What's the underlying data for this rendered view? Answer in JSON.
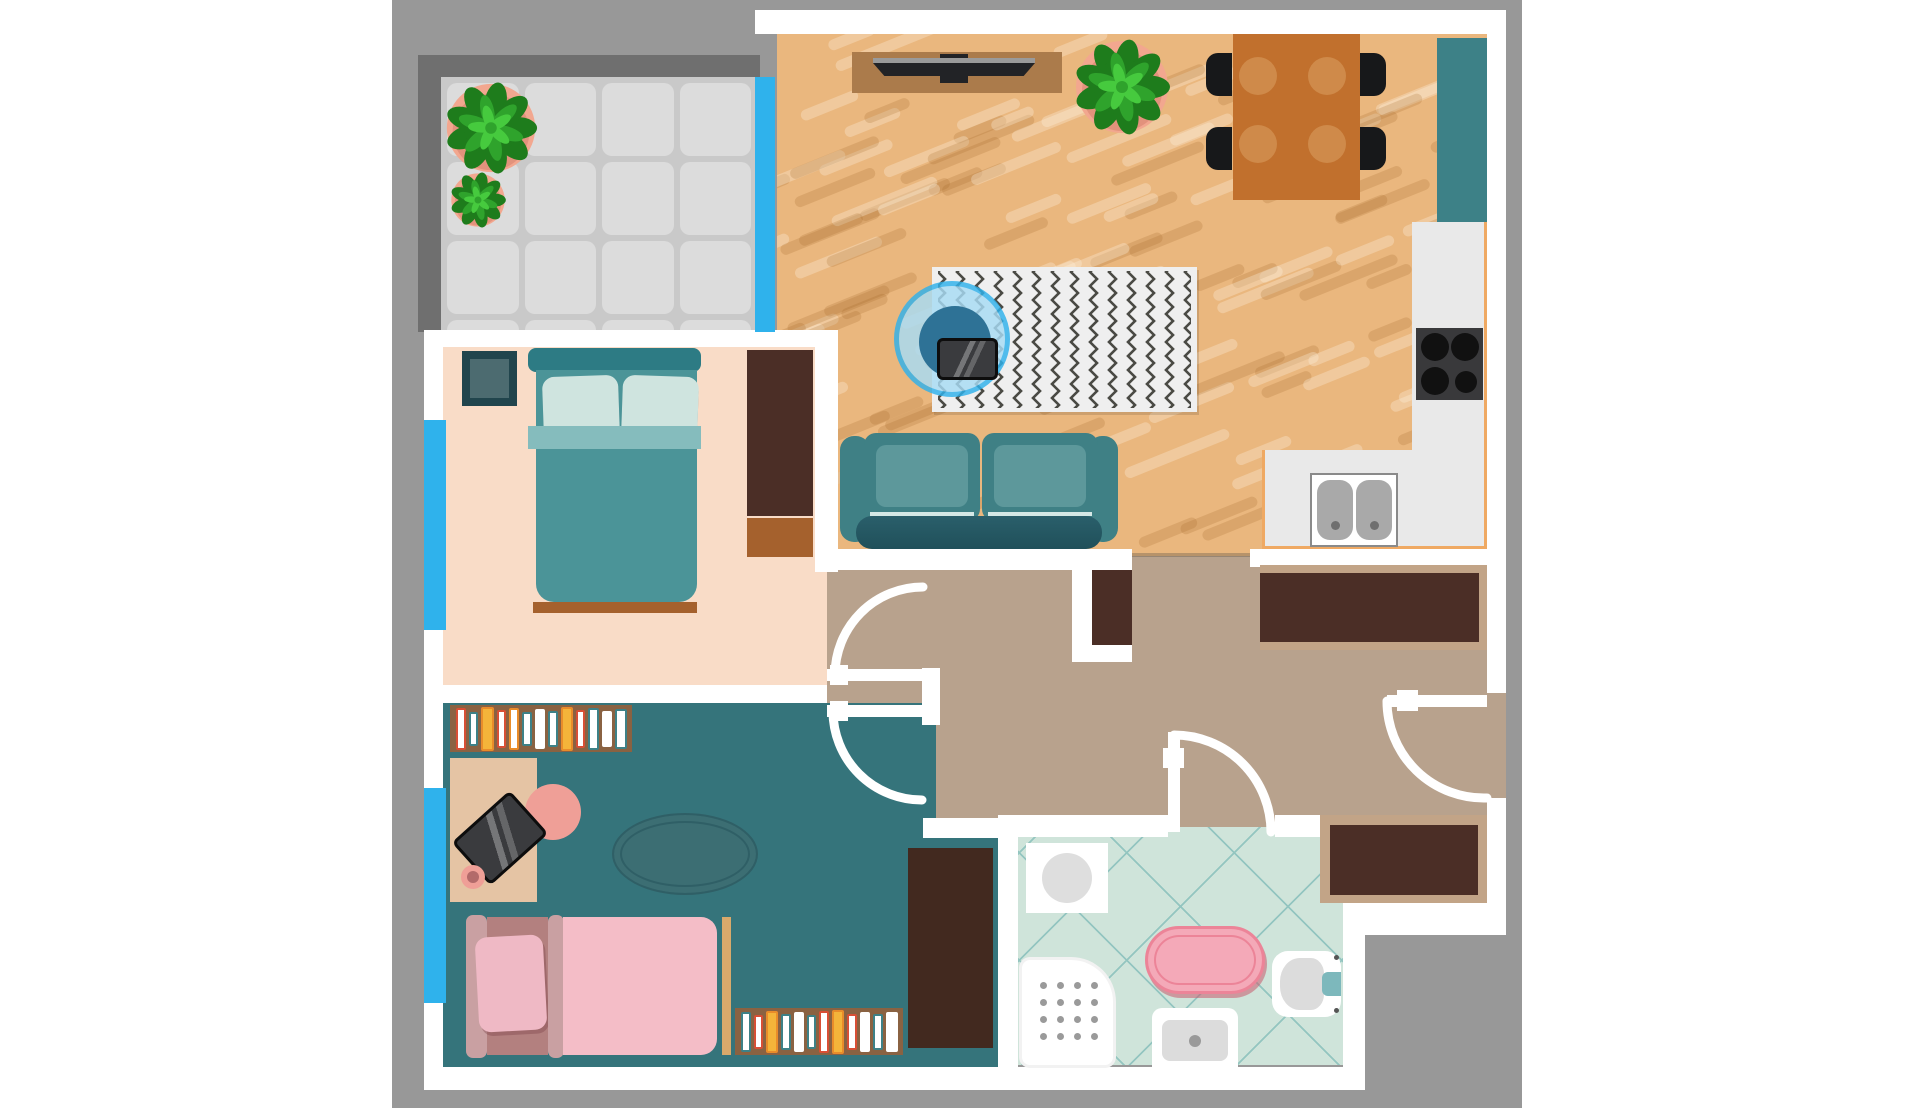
{
  "scene": {
    "type": "apartment-floor-plan-top-view",
    "text_content": "none (illustration only)"
  },
  "palette": {
    "backdrop": "#989898",
    "wall": "#ffffff",
    "balcony_frame": "#6f6f6f",
    "tile_bg": "#c9c9c9",
    "tile": "#dcdcdc",
    "wood": "#eab77e",
    "wood_light": "rgba(255,246,228,0.30)",
    "wood_dark": "rgba(166,106,41,0.22)",
    "window": "#2fb2ec",
    "hallway": "#b8a28d",
    "bedroom": "#f9dcc7",
    "kidsroom": "#35747b",
    "bathroom": "#cfe4da",
    "bath_line": "#93c5c0",
    "closet_dark": "#4b2e26",
    "closet_trim": "#c2a487",
    "counter": "#e9e9e9",
    "counter_edge": "#efa963",
    "cabinet_teal": "#3d8187",
    "stove": "#39393b",
    "burner": "#111111",
    "sink_gray": "#a9a9a9",
    "sofa": "#3f8085",
    "sofa_inner": "#5d989b",
    "sofa_dark": "#20505a",
    "bed_frame": "#4b9498",
    "bed_head": "#2d7b84",
    "bed_band": "#85bcbd",
    "pillow": "#cfe4df",
    "pillow_edge": "#2a6f78",
    "foot_brown": "#a5612d",
    "table_wood": "#c1702d",
    "plate": "#cf8a4a",
    "chair_black": "#17181a",
    "rug_bg": "#efefef",
    "rug_zig": "#4a4a44",
    "chair_blue_ring": "#2fb2ec",
    "chair_blue": "#a8dcf5",
    "chair_blue_inner": "#2e7296",
    "laptop": "#3a3b3e",
    "plant_pot": "#f2a78f",
    "plant_dark": "#1e7c1c",
    "plant_mid": "#2fa32c",
    "plant_light": "#46ca3e",
    "kid_floor_rug": "#3c6e73",
    "kid_bed_head": "#c9a0a2",
    "kid_bed_mat": "#b3807f",
    "kid_pillow": "#efb9c5",
    "kid_blanket": "#f4bdc7",
    "kid_bar_tan": "#d9a96b",
    "desk": "#e5c4a4",
    "chair_pink": "#ef9f97",
    "shelf_brown": "#8a6242",
    "tub_pink": "#f4a9b8",
    "tub_edge": "#ec8498",
    "toilet_btn": "#7db8bc",
    "dot_gray": "#9a9a9a",
    "tv_stand": "#ab7b4b",
    "tv_dark": "#222326"
  },
  "rooms": [
    {
      "id": "balcony"
    },
    {
      "id": "living-room-with-kitchen"
    },
    {
      "id": "bedroom"
    },
    {
      "id": "kids-room"
    },
    {
      "id": "bathroom"
    },
    {
      "id": "hallway"
    }
  ],
  "balcony": {
    "tiles": {
      "rows": 4,
      "cols": 4,
      "size": 73,
      "gap": 6
    },
    "plants": [
      "large-potted-plant",
      "small-potted-plant"
    ]
  },
  "living_room": {
    "planks": {
      "count": 160,
      "angle": -22,
      "seed": 13
    },
    "furniture": [
      "tv-stand",
      "tv",
      "potted-plant",
      "dining-table",
      "four-black-chairs",
      "zigzag-rug",
      "hanging-chair",
      "laptop",
      "sofa"
    ]
  },
  "dining": {
    "plates": [
      {
        "x": 25,
        "y": 42
      },
      {
        "x": 94,
        "y": 42
      },
      {
        "x": 25,
        "y": 110
      },
      {
        "x": 94,
        "y": 110
      }
    ],
    "plate_r": 19,
    "chair_count": 4
  },
  "kitchen": {
    "burners": [
      {
        "x": 19,
        "y": 19,
        "r": 14
      },
      {
        "x": 49,
        "y": 19,
        "r": 14
      },
      {
        "x": 19,
        "y": 53,
        "r": 14
      },
      {
        "x": 50,
        "y": 54,
        "r": 11
      }
    ],
    "sink_basins": 2,
    "elements": [
      "tall-teal-cabinet",
      "counter",
      "stove",
      "double-sink"
    ]
  },
  "bedroom": {
    "furniture": [
      "side-table",
      "double-bed",
      "two-pillows",
      "wardrobe",
      "dresser"
    ]
  },
  "kids_room": {
    "shelf_a_books": [
      {
        "w": 11,
        "h": 42,
        "f": "#ffffff",
        "e": "#d84f35"
      },
      {
        "w": 10,
        "h": 34,
        "f": "#ffffff",
        "e": "#3d8187"
      },
      {
        "w": 13,
        "h": 44,
        "f": "#f4b43a",
        "e": "#e98c2a"
      },
      {
        "w": 10,
        "h": 38,
        "f": "#ffffff",
        "e": "#d84f35"
      },
      {
        "w": 11,
        "h": 42,
        "f": "#ffffff",
        "e": "#e98c2a"
      },
      {
        "w": 10,
        "h": 34,
        "f": "#ffffff",
        "e": "#3d8187"
      },
      {
        "w": 11,
        "h": 40,
        "f": "#ffffff",
        "e": "#ffffff"
      },
      {
        "w": 10,
        "h": 36,
        "f": "#ffffff",
        "e": "#3d8187"
      },
      {
        "w": 13,
        "h": 44,
        "f": "#f4b43a",
        "e": "#e98c2a"
      },
      {
        "w": 10,
        "h": 38,
        "f": "#ffffff",
        "e": "#d84f35"
      },
      {
        "w": 11,
        "h": 42,
        "f": "#ffffff",
        "e": "#3d8187"
      },
      {
        "w": 11,
        "h": 36,
        "f": "#ffffff",
        "e": "#ffffff"
      },
      {
        "w": 12,
        "h": 40,
        "f": "#ffffff",
        "e": "#3d8187"
      }
    ],
    "shelf_b_books": [
      {
        "w": 11,
        "h": 40,
        "f": "#ffffff",
        "e": "#3d8187"
      },
      {
        "w": 10,
        "h": 34,
        "f": "#ffffff",
        "e": "#d84f35"
      },
      {
        "w": 13,
        "h": 42,
        "f": "#f4b43a",
        "e": "#e98c2a"
      },
      {
        "w": 10,
        "h": 36,
        "f": "#ffffff",
        "e": "#3d8187"
      },
      {
        "w": 11,
        "h": 40,
        "f": "#ffffff",
        "e": "#ffffff"
      },
      {
        "w": 10,
        "h": 34,
        "f": "#ffffff",
        "e": "#3d8187"
      },
      {
        "w": 11,
        "h": 42,
        "f": "#ffffff",
        "e": "#d84f35"
      },
      {
        "w": 13,
        "h": 44,
        "f": "#f4b43a",
        "e": "#e98c2a"
      },
      {
        "w": 10,
        "h": 36,
        "f": "#ffffff",
        "e": "#d84f35"
      },
      {
        "w": 11,
        "h": 40,
        "f": "#ffffff",
        "e": "#ffffff"
      },
      {
        "w": 11,
        "h": 36,
        "f": "#ffffff",
        "e": "#3d8187"
      },
      {
        "w": 12,
        "h": 40,
        "f": "#ffffff",
        "e": "#ffffff"
      }
    ],
    "furniture": [
      "bookshelf-top",
      "desk",
      "laptop",
      "pink-desk-chair",
      "cup",
      "oval-rug",
      "single-bed",
      "bookshelf-bottom",
      "wardrobe"
    ]
  },
  "bathroom": {
    "shower_dots": {
      "rows": 4,
      "cols": 4,
      "step": 17,
      "x0": 18,
      "y0": 22,
      "r": 3.5
    },
    "fixtures": [
      "washing-machine",
      "shower-tray",
      "pink-bathtub",
      "sink",
      "toilet"
    ]
  },
  "doors": {
    "count": 4,
    "style": "white-leaf-with-quarter-arc",
    "locations": [
      "bedroom",
      "kids-room",
      "bathroom",
      "entrance"
    ]
  },
  "windows": {
    "count": 3,
    "locations": [
      "balcony-living",
      "bedroom-left",
      "kids-room-left"
    ]
  }
}
